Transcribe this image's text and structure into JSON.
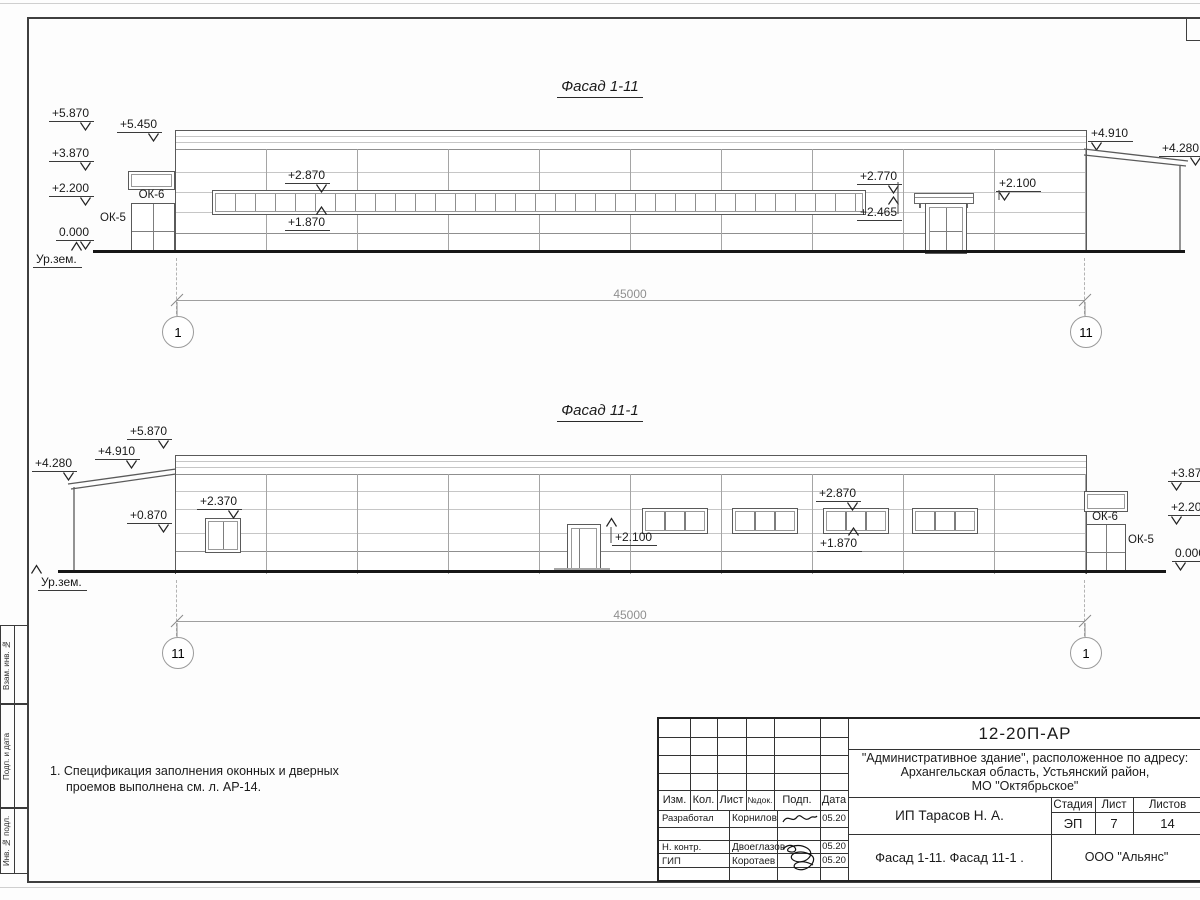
{
  "facade1": {
    "title": "Фасад 1-11",
    "dim": "45000",
    "axis_left": "1",
    "axis_right": "11",
    "elev": {
      "e5870": "+5.870",
      "e5450": "+5.450",
      "e3870": "+3.870",
      "e2200": "+2.200",
      "e0000": "0.000",
      "ground": "Ур.зем.",
      "e2870": "+2.870",
      "e1870": "+1.870",
      "e2770": "+2.770",
      "e2465": "+2.465",
      "e2100": "+2.100",
      "e4910": "+4.910",
      "e4280": "+4.280",
      "ok5": "ОК-5",
      "ok6": "ОК-6"
    }
  },
  "facade2": {
    "title": "Фасад 11-1",
    "dim": "45000",
    "axis_left": "11",
    "axis_right": "1",
    "elev": {
      "e5870": "+5.870",
      "e4910": "+4.910",
      "e4280": "+4.280",
      "e2370": "+2.370",
      "e0870": "+0.870",
      "ground": "Ур.зем.",
      "e2100": "+2.100",
      "e2870": "+2.870",
      "e1870": "+1.870",
      "e3870": "+3.870",
      "e2200": "+2.200",
      "e0000": "0.000",
      "ok5": "ОК-5",
      "ok6": "ОК-6"
    }
  },
  "note": {
    "line1": "1. Спецификация заполнения оконных и дверных",
    "line2": "проемов выполнена см. л. АР-14."
  },
  "titleblock": {
    "doc_number": "12-20П-АР",
    "project_line1": "\"Административное здание\", расположенное по адресу:",
    "project_line2": "Архангельская область, Устьянский район,",
    "project_line3": "МО \"Октябрьское\"",
    "col_izm": "Изм.",
    "col_kol": "Кол.",
    "col_list": "Лист",
    "col_ndok": "№док.",
    "col_podp": "Подп.",
    "col_data": "Дата",
    "rows": [
      {
        "role": "Разработал",
        "name": "Корнилов",
        "date": "05.20"
      },
      {
        "role": "Н. контр.",
        "name": "Двоеглазов",
        "date": "05.20"
      },
      {
        "role": "ГИП",
        "name": "Коротаев",
        "date": "05.20"
      }
    ],
    "client": "ИП Тарасов Н. А.",
    "sheet_title": "Фасад 1-11. Фасад 11-1 .",
    "stage_label": "Стадия",
    "list_label": "Лист",
    "listov_label": "Листов",
    "stage": "ЭП",
    "sheet_no": "7",
    "sheets_total": "14",
    "org": "ООО \"Альянс\""
  },
  "side_strip": {
    "row1": "Взам. инв. №",
    "row2": "Подп. и дата",
    "row3": "Инв. № подл."
  }
}
